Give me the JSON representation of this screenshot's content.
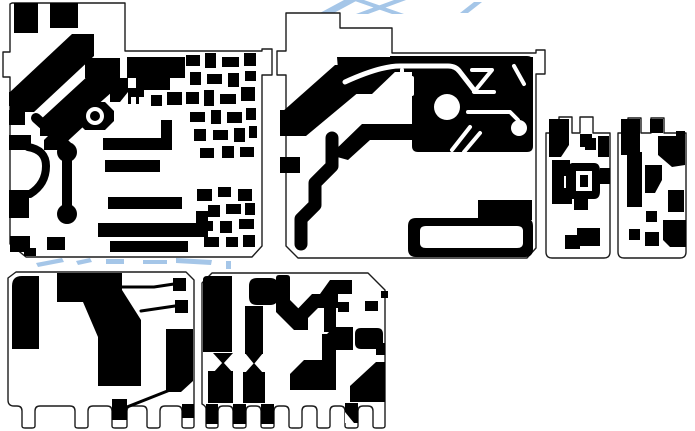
{
  "canvas": {
    "width": 695,
    "height": 431,
    "background": "#ffffff",
    "copper_color": "#000000",
    "board_fill": "#ffffff",
    "outline_color": "#1c1c1c",
    "outline_width": 1.4,
    "watermark_color": "#a5c6e8"
  },
  "watermark": {
    "fragments": [
      "M318,14L344,0h14L332,14Z",
      "M352,0l40,14h12L364,0Z",
      "M394,0L356,14h12L406,0Z",
      "M460,13L474,2h8L468,13Z",
      "M36,263l26,-5 2,4-26,5z",
      "M76,261l14,-3 2,4-14,3z",
      "M106,259h18v5h-18z",
      "M143,260h24v4h-24z",
      "M176,258l36,2-1,5-35,-2z",
      "M226,261h5v8h-5z"
    ]
  },
  "boards": [
    {
      "name": "board-top-left",
      "outline": "M12,3H125V51H262V49H272V75H262V246L252,257H26L10,244V77H3V52H10V4Z",
      "copper": [
        "M14,3h24v30h-24z",
        "M50,3h28v25h-28z",
        "M10,92L72,34h22v22L34,112H10Z",
        "M85,58h35v20h-35z",
        "M40,120L90,74h22v18L62,136H40Z",
        "M127,57h58v21h-15v12h-34v-12h-9z",
        "M128,88h16v9h-5v7h-3v-7h-5v7h-3z",
        "M151,95h11v11h-11z",
        "M167,92h15v13h-15z",
        "M110,78h18v14l-8,10h-10z",
        "M85,102h20l9,9v10l-9,9h-20l-9,-9v-10z",
        "M44,140L70,114h14v12L58,150H44Z",
        "M62,150h10v64h-10z",
        "M57,152a10,10 0 1,0 20,0a10,10 0 1,0 -20,0Z",
        "M57,214a10,10 0 1,0 20,0a10,10 0 1,0 -20,0Z",
        "M103,138h69v12h-69z",
        "M161,120h11v20h-11z",
        "M105,160h55v12h-55z",
        "M9,92h23v14h-23z",
        "M9,110h16v15h-16z",
        "M9,135h22v15h-22z",
        "M9,190h20v28h-20z",
        "M10,236h20v16h-20z",
        "M47,237h18v13h-18z",
        "M24,248h12v8h-12z",
        "M108,197h74v12h-74z",
        "M98,223h110v14h-110z",
        "M196,211h12v13h-12z",
        "M110,241h78v11h-78z",
        "M186,55h14v11h-14z",
        "M205,53h11v15h-11z",
        "M222,57h17v10h-17z",
        "M244,53h12v13h-12z",
        "M190,72h11v13h-11z",
        "M207,74h15v10h-15z",
        "M228,73h11v14h-11z",
        "M245,71h11v10h-11z",
        "M186,92h13v12h-13z",
        "M204,90h10v16h-10z",
        "M220,94h16v10h-16z",
        "M241,87h14v14h-14z",
        "M190,112h15v10h-15z",
        "M211,110h10v14h-10z",
        "M227,112h15v11h-15z",
        "M246,108h10v12h-10z",
        "M194,129h12v12h-12z",
        "M213,130h15v10h-15z",
        "M234,128h11v14h-11z",
        "M249,126h8v12h-8z",
        "M200,148h14v10h-14z",
        "M222,146h12v12h-12z",
        "M240,147h14v10h-14z",
        "M197,189h15v12h-15z",
        "M218,187h13v10h-13z",
        "M238,189h14v12h-14z",
        "M208,205h12v12h-12z",
        "M226,204h15v10h-15z",
        "M245,203h10v12h-10z",
        "M199,221h14v10h-14z",
        "M220,221h12v12h-12z",
        "M239,219h15v10h-15z",
        "M204,237h15v10h-15z",
        "M226,237h12v10h-12z",
        "M243,235h12v12h-12z"
      ],
      "copper_strokes": [
        {
          "d": "M28,147Q46,150 46,166Q46,184 30,194",
          "w": 8
        },
        {
          "d": "M36,118L67,146",
          "w": 10
        }
      ],
      "clearance_shapes": [
        "M86,116a9,9 0 1,0 18,0a9,9 0 1,0 -18,0Z"
      ],
      "clearance_strokes": [],
      "copper_top": [
        "M90,116a5,5 0 1,0 10,0a5,5 0 1,0 -10,0Z"
      ]
    },
    {
      "name": "board-top-middle",
      "outline": "M286,13H340V28H392V53H536V50H545V74H536V248L527,258H298L286,246V75H277V51H286V13Z",
      "copper": [
        "M337,57H533V70H397L372,94H340Z",
        "M282,112L335,65h31v21L306,136H282Z",
        "M280,110h26v26h-26z",
        "M280,157h20v16h-20z",
        "M412,56h115q6,0 6,6v84q0,6 -6,6H418q-6,0 -6,-6z",
        "M390,56h40v16h-40z",
        "M330,155l32,-31h93v16h-85l-22,20z",
        "M478,200h54v20h-54z",
        "M408,226q0,-8 8,-8h109q8,0 8,8v23q0,8 -8,8H416q-8,0 -8,-8z"
      ],
      "copper_strokes": [
        {
          "d": "M332,138v28l-17,17v22l-14,14v25",
          "w": 13
        }
      ],
      "clearance_shapes": [
        "M434,107a13,13 0 1,0 26,0a13,13 0 1,0 -26,0Z",
        "M511,128a8,8 0 1,0 16,0a8,8 0 1,0 -16,0Z",
        "M420,231q0,-5 6,-5h91q6,0 6,5v12q0,5 -6,5h-91q-6,0 -6,-5z"
      ],
      "clearance_strokes": [
        {
          "d": "M345,82Q380,66 400,66h48q8,0 12,6l14,18",
          "w": 5
        },
        {
          "d": "M402,70v24h10V78",
          "w": 4
        },
        {
          "d": "M472,70h20l-18,22h20",
          "w": 4
        },
        {
          "d": "M514,66l10,18",
          "w": 4
        },
        {
          "d": "M468,112h42l8,8v4",
          "w": 4
        },
        {
          "d": "M452,150l18,-23",
          "w": 4
        },
        {
          "d": "M464,152l16,-19",
          "w": 4
        }
      ],
      "copper_top": []
    },
    {
      "name": "board-small-left",
      "outline": "M546,133H559V117H572V133H580V117H593V133H610V252Q610,258 604,258H552Q546,258 546,252Z",
      "copper": [
        "M549,119h20v26l-8,12h-12z",
        "M580,134h12v13h-12z",
        "M598,136h11v21h-11z",
        "M585,138h11v12h-11z",
        "M552,160h18v16h-6v12h8v16h-20z",
        "M572,163h22q6,0 6,8v20q0,8 -6,8h-22q-6,-2 -6,-10v-16q0,-8 6,-10z",
        "M574,198h14v12h-14z",
        "M600,168h10v16h-10z",
        "M565,249v-14h12v-7h23v18h-20v3z"
      ],
      "copper_strokes": [],
      "clearance_shapes": [
        "M576,171h16v20h-16z"
      ],
      "clearance_strokes": [],
      "copper_top": [
        "M580,175h8v12h-8z"
      ]
    },
    {
      "name": "board-small-right",
      "outline": "M618,133H628V118H641V133H651V118H664V133H686V252Q686,258 680,258H624Q618,258 618,252Z",
      "copper": [
        "M621,119h19v36h-19z",
        "M650,119h13v14h-13z",
        "M658,136h27v29l-13,2-14,-12z",
        "M676,131h9v6h-9z",
        "M627,152h15v55h-15z",
        "M645,165h17v15l-7,13h-10z",
        "M668,190h16v22h-16z",
        "M646,211h11v11h-11z",
        "M663,220h23v27h-16l-7,-7z",
        "M645,232h14v14h-14z",
        "M629,229h11v11h-11z"
      ],
      "copper_strokes": [],
      "clearance_shapes": [],
      "clearance_strokes": [],
      "copper_top": []
    },
    {
      "name": "board-bottom-left",
      "outline": "M16,272H186L194,280V426Q194,428 191,428H185Q182,428 182,426V411Q182,406 177,406H165Q160,406 160,411V426Q160,428 157,428H150Q147,428 147,426V411Q147,406 142,406H132Q127,406 127,411V426Q127,428 124,428H115Q112,428 112,426V411Q112,406 107,406H93Q88,406 88,411V426Q88,428 85,428H78Q75,428 75,426V411Q75,406 70,406H40Q35,406 35,411V426Q35,428 32,428H25Q22,428 22,426V411Q22,406 17,406H14Q8,406 8,400V278Z",
      "copper": [
        "M12,349v-63q0,-10 10,-10h17v73z",
        "M57,273H122V290L141,320V386H98V337L83,302H57Z",
        "M173,278h13v13h-13z",
        "M175,300h13v13h-13z",
        "M166,329h27v52l-12,11h-15z",
        "M112,399h15v21h-15z",
        "M182,404h12v14h-12z"
      ],
      "copper_strokes": [
        {
          "d": "M122,287h32l20,-3",
          "w": 3
        },
        {
          "d": "M141,311l34,-5",
          "w": 3
        },
        {
          "d": "M170,390L122,409",
          "w": 3
        }
      ],
      "clearance_shapes": [],
      "clearance_strokes": [],
      "copper_top": []
    },
    {
      "name": "board-bottom-middle",
      "outline": "M212,273H368L385,290V426Q385,428 382,428H376Q373,428 373,426V411Q373,406 368,406H363Q358,406 358,411V426Q358,428 355,428H348Q345,428 345,426V411Q345,406 340,406H335Q330,406 330,411V426Q330,428 327,428H320Q317,428 317,426V411Q317,406 312,406H307Q302,406 302,411V426Q302,428 299,428H292Q289,428 289,426V411Q289,406 284,406H279Q274,406 274,411V426Q274,428 271,428H264Q261,428 261,426V411Q261,406 256,406H251Q246,406 246,411V426Q246,428 243,428H236Q233,428 233,426V411Q233,406 228,406H223Q218,406 218,411V426Q218,428 215,428H209Q206,428 206,426V409Q206,406 202,404V283Z",
      "copper": [
        "M203,280q0,-4 4,-4h25v76h-29z",
        "M213,353h20l-10,11z",
        "M213,373l10,-11 10,11z",
        "M208,371h25v32h-25z",
        "M206,404h12v20h-12z",
        "M233,404h13v20h-13z",
        "M261,404h13v20h-13z",
        "M249,286q0,-8 8,-8h13q8,0 8,8v11q0,8 -8,8h-13q-8,0 -8,-8z",
        "M245,306h18v48h-18z",
        "M245,353h18l-9,11z",
        "M245,373l9,-10 9,10z",
        "M243,372h22v31h-22z",
        "M276,278q0,-3 3,-3h8q3,0 3,3v22h-14z",
        "M276,300h14l18,18v12h-14l-18,-18z",
        "M290,317l22,-23h26v14h-20l-16,16z",
        "M324,306h12v26h-12z",
        "M330,280h22v14h-32z",
        "M338,302h11v10h-11z",
        "M365,301h13v10h-13z",
        "M381,291h7v7h-7z",
        "M327,350v-16l7,-7h19v23z",
        "M355,334q0,-6 6,-6h16q6,0 6,6v9q0,6 -6,6h-16q-6,0 -6,-6z",
        "M290,390v-16l14,-14h18v-26h14v56z",
        "M350,402v-16l26,-24h9v40z",
        "M345,403h13v20h-13z",
        "M376,343h9v12h-9z"
      ],
      "copper_strokes": [],
      "clearance_shapes": [
        "M345,412l9,11h-9z"
      ],
      "clearance_strokes": [],
      "copper_top": []
    }
  ]
}
